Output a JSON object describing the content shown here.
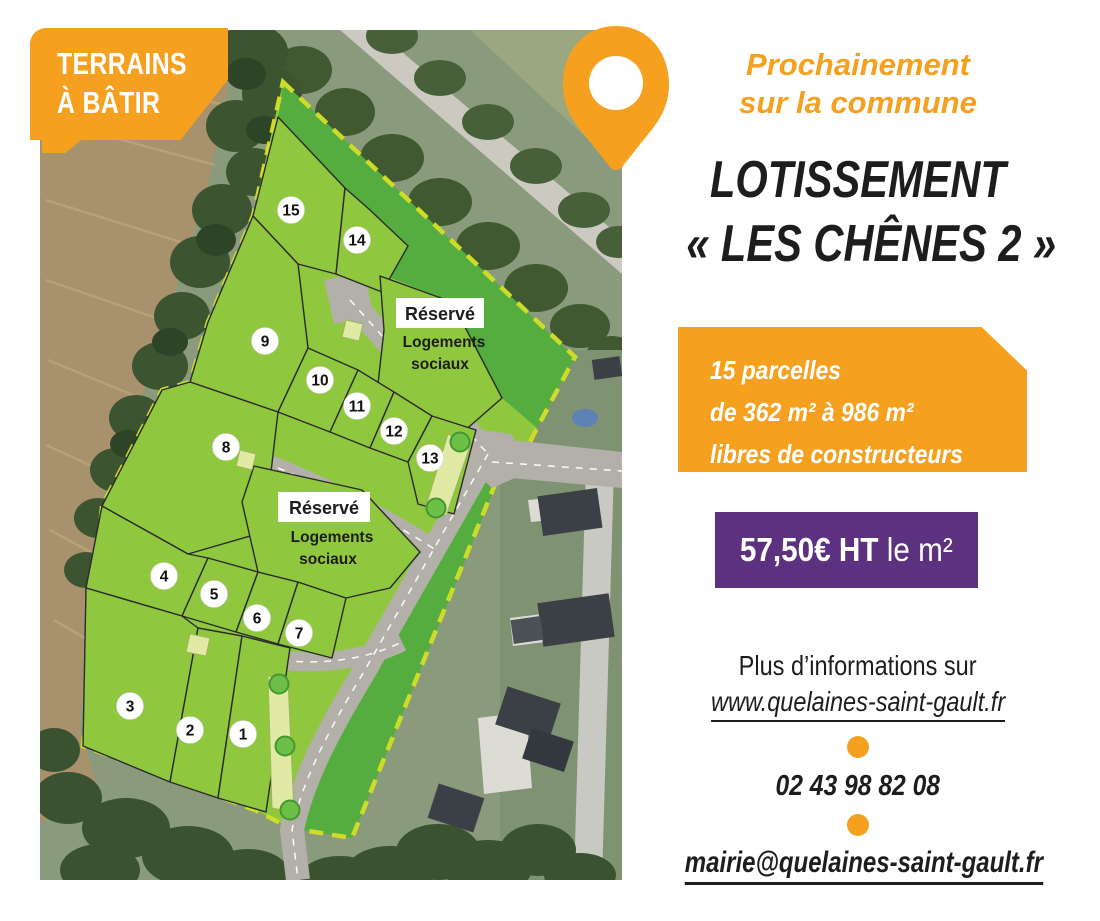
{
  "badge": {
    "line1": "TERRAINS",
    "line2": "À BÂTIR"
  },
  "header": {
    "kicker_line1": "Prochainement",
    "kicker_line2": "sur la commune",
    "title_line1": "LOTISSEMENT",
    "title_line2": "« LES CHÊNES 2 »"
  },
  "offer_box": {
    "line1": "15 parcelles",
    "line2": "de 362 m² à 986 m²",
    "line3": "libres de constructeurs"
  },
  "price_box": {
    "amount": "57,50€ HT",
    "unit": " le m²"
  },
  "contact": {
    "info_label": "Plus d’informations sur",
    "website": "www.quelaines-saint-gault.fr",
    "phone": "02 43 98 82 08",
    "email": "mairie@quelaines-saint-gault.fr"
  },
  "map": {
    "reserved_labels": [
      {
        "title": "Réservé",
        "line1": "Logements",
        "line2": "sociaux"
      },
      {
        "title": "Réservé",
        "line1": "Logements",
        "line2": "sociaux"
      }
    ],
    "parcels": [
      {
        "n": "1",
        "x": 203,
        "y": 704
      },
      {
        "n": "2",
        "x": 150,
        "y": 700
      },
      {
        "n": "3",
        "x": 90,
        "y": 676
      },
      {
        "n": "4",
        "x": 124,
        "y": 546
      },
      {
        "n": "5",
        "x": 174,
        "y": 564
      },
      {
        "n": "6",
        "x": 217,
        "y": 588
      },
      {
        "n": "7",
        "x": 259,
        "y": 603
      },
      {
        "n": "8",
        "x": 186,
        "y": 417
      },
      {
        "n": "9",
        "x": 225,
        "y": 311
      },
      {
        "n": "10",
        "x": 280,
        "y": 350
      },
      {
        "n": "11",
        "x": 317,
        "y": 376
      },
      {
        "n": "12",
        "x": 354,
        "y": 401
      },
      {
        "n": "13",
        "x": 390,
        "y": 428
      },
      {
        "n": "14",
        "x": 317,
        "y": 210
      },
      {
        "n": "15",
        "x": 251,
        "y": 180
      }
    ]
  },
  "colors": {
    "orange": "#F5A01F",
    "purple": "#5B3180",
    "parcel_green": "#8FC73F",
    "reserve_green": "#55AC3F",
    "road_gray": "#B2B0A8",
    "boundary_dash": "#CDDC29",
    "strip_yellow": "#E0EAA4",
    "text_dark": "#1D1D1B"
  }
}
